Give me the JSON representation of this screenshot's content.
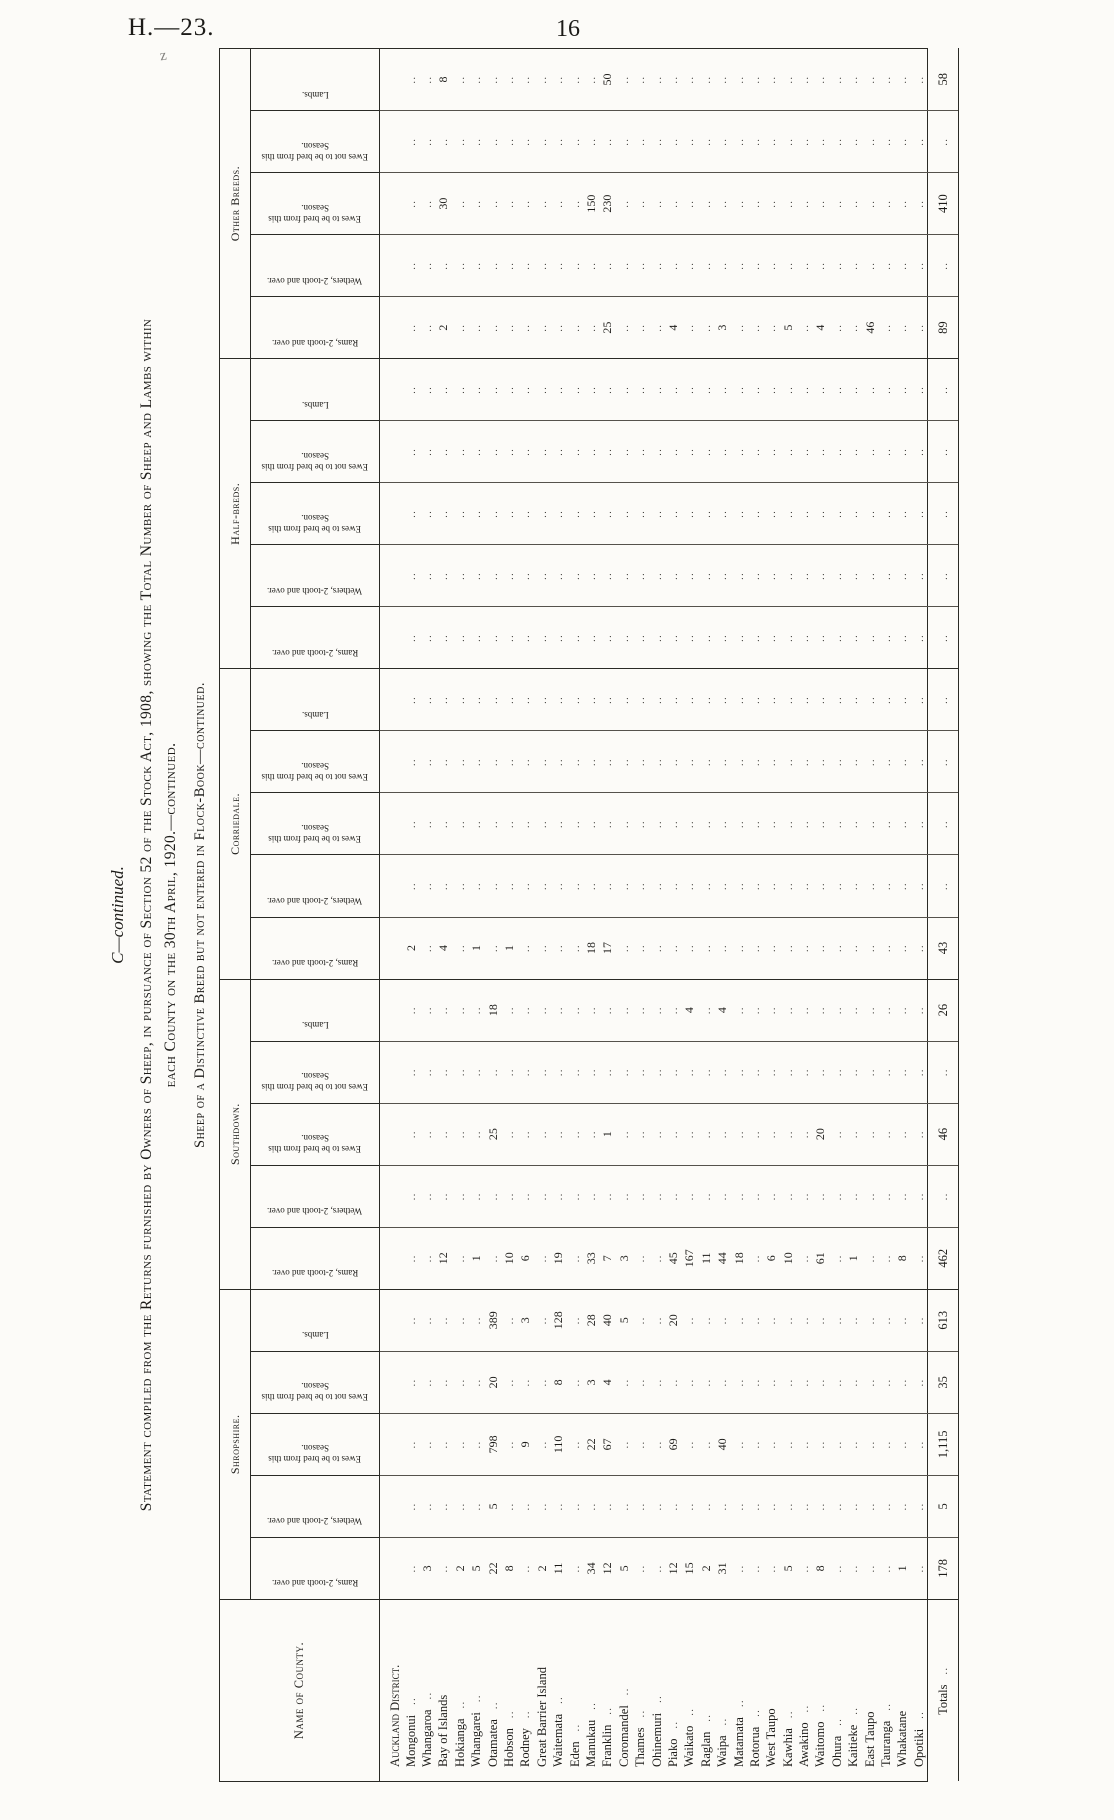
{
  "page": {
    "doc_ref": "H.—23.",
    "page_number": "16",
    "pen_mark": "z"
  },
  "heading": {
    "series": "C—continued.",
    "title_line1": "Statement compiled from the Returns furnished by Owners of Sheep, in pursuance of Section 52 of the Stock Act, 1908, showing the Total Number of Sheep and Lambs within",
    "title_line2": "each County on the 30th April, 1920.—continued.",
    "subtitle": "Sheep of a Distinctive Breed but not entered in Flock-Book—continued."
  },
  "table": {
    "name_col_header": "Name of County.",
    "empty_marker": "..",
    "group_labels": [
      "Shropshire.",
      "Southdown.",
      "Corriedale.",
      "Half-breds.",
      "Other Breeds."
    ],
    "sub_headers": [
      "Rams, 2-tooth and over.",
      "Wethers, 2-tooth and over.",
      "Ewes to be bred from this Season.",
      "Ewes not to be bred from this Season.",
      "Lambs."
    ],
    "district_header": "Auckland District.",
    "rows": [
      {
        "n": "Mongonui",
        "lr": true,
        "c": [
          "",
          "",
          "",
          "",
          "",
          "",
          "",
          "",
          "",
          "",
          "2",
          "",
          "",
          "",
          "",
          "",
          "",
          "",
          "",
          "",
          "",
          "",
          "",
          "",
          ""
        ]
      },
      {
        "n": "Whangaroa",
        "lr": true,
        "c": [
          "3",
          "",
          "",
          "",
          "",
          "",
          "",
          "",
          "",
          "",
          "",
          "",
          "",
          "",
          "",
          "",
          "",
          "",
          "",
          "",
          "",
          "",
          "",
          "",
          ""
        ]
      },
      {
        "n": "Bay of Islands",
        "lr": false,
        "c": [
          "",
          "",
          "",
          "",
          "",
          "12",
          "",
          "",
          "",
          "",
          "4",
          "",
          "",
          "",
          "",
          "",
          "",
          "",
          "",
          "",
          "2",
          "",
          "30",
          "",
          "8"
        ]
      },
      {
        "n": "Hokianga",
        "lr": true,
        "c": [
          "2",
          "",
          "",
          "",
          "",
          "",
          "",
          "",
          "",
          "",
          "",
          "",
          "",
          "",
          "",
          "",
          "",
          "",
          "",
          "",
          "",
          "",
          "",
          "",
          ""
        ]
      },
      {
        "n": "Whangarei",
        "lr": true,
        "c": [
          "5",
          "",
          "",
          "",
          "",
          "1",
          "",
          "",
          "",
          "",
          "1",
          "",
          "",
          "",
          "",
          "",
          "",
          "",
          "",
          "",
          "",
          "",
          "",
          "",
          ""
        ]
      },
      {
        "n": "Otamatea",
        "lr": true,
        "c": [
          "22",
          "5",
          "798",
          "20",
          "389",
          "",
          "",
          "25",
          "",
          "18",
          "",
          "",
          "",
          "",
          "",
          "",
          "",
          "",
          "",
          "",
          "",
          "",
          "",
          "",
          ""
        ]
      },
      {
        "n": "Hobson",
        "lr": true,
        "c": [
          "8",
          "",
          "",
          "",
          "",
          "10",
          "",
          "",
          "",
          "",
          "1",
          "",
          "",
          "",
          "",
          "",
          "",
          "",
          "",
          "",
          "",
          "",
          "",
          "",
          ""
        ]
      },
      {
        "n": "Rodney",
        "lr": true,
        "c": [
          "",
          "",
          "9",
          "",
          "3",
          "6",
          "",
          "",
          "",
          "",
          "",
          "",
          "",
          "",
          "",
          "",
          "",
          "",
          "",
          "",
          "",
          "",
          "",
          "",
          ""
        ]
      },
      {
        "n": "Great Barrier Island",
        "lr": false,
        "c": [
          "2",
          "",
          "",
          "",
          "",
          "",
          "",
          "",
          "",
          "",
          "",
          "",
          "",
          "",
          "",
          "",
          "",
          "",
          "",
          "",
          "",
          "",
          "",
          "",
          ""
        ]
      },
      {
        "n": "Waitemata",
        "lr": true,
        "c": [
          "11",
          "",
          "110",
          "8",
          "128",
          "19",
          "",
          "",
          "",
          "",
          "",
          "",
          "",
          "",
          "",
          "",
          "",
          "",
          "",
          "",
          "",
          "",
          "",
          "",
          ""
        ]
      },
      {
        "n": "Eden",
        "lr": true,
        "c": [
          "",
          "",
          "",
          "",
          "",
          "",
          "",
          "",
          "",
          "",
          "",
          "",
          "",
          "",
          "",
          "",
          "",
          "",
          "",
          "",
          "",
          "",
          "",
          "",
          ""
        ]
      },
      {
        "n": "Manukau",
        "lr": true,
        "c": [
          "34",
          "",
          "22",
          "3",
          "28",
          "33",
          "",
          "",
          "",
          "",
          "18",
          "",
          "",
          "",
          "",
          "",
          "",
          "",
          "",
          "",
          "",
          "",
          "150",
          "",
          ""
        ]
      },
      {
        "n": "Franklin",
        "lr": true,
        "c": [
          "12",
          "",
          "67",
          "4",
          "40",
          "7",
          "",
          "1",
          "",
          "",
          "17",
          "",
          "",
          "",
          "",
          "",
          "",
          "",
          "",
          "",
          "25",
          "",
          "230",
          "",
          "50"
        ]
      },
      {
        "n": "Coromandel",
        "lr": true,
        "c": [
          "5",
          "",
          "",
          "",
          "5",
          "3",
          "",
          "",
          "",
          "",
          "",
          "",
          "",
          "",
          "",
          "",
          "",
          "",
          "",
          "",
          "",
          "",
          "",
          "",
          ""
        ]
      },
      {
        "n": "Thames",
        "lr": true,
        "c": [
          "",
          "",
          "",
          "",
          "",
          "",
          "",
          "",
          "",
          "",
          "",
          "",
          "",
          "",
          "",
          "",
          "",
          "",
          "",
          "",
          "",
          "",
          "",
          "",
          ""
        ]
      },
      {
        "n": "Ohinemuri",
        "lr": true,
        "c": [
          "",
          "",
          "",
          "",
          "",
          "",
          "",
          "",
          "",
          "",
          "",
          "",
          "",
          "",
          "",
          "",
          "",
          "",
          "",
          "",
          "",
          "",
          "",
          "",
          ""
        ]
      },
      {
        "n": "Piako",
        "lr": true,
        "c": [
          "12",
          "",
          "69",
          "",
          "20",
          "45",
          "",
          "",
          "",
          "",
          "",
          "",
          "",
          "",
          "",
          "",
          "",
          "",
          "",
          "",
          "4",
          "",
          "",
          "",
          ""
        ]
      },
      {
        "n": "Waikato",
        "lr": true,
        "c": [
          "15",
          "",
          "",
          "",
          "",
          "167",
          "",
          "",
          "",
          "4",
          "",
          "",
          "",
          "",
          "",
          "",
          "",
          "",
          "",
          "",
          "",
          "",
          "",
          "",
          ""
        ]
      },
      {
        "n": "Raglan",
        "lr": true,
        "c": [
          "2",
          "",
          "",
          "",
          "",
          "11",
          "",
          "",
          "",
          "",
          "",
          "",
          "",
          "",
          "",
          "",
          "",
          "",
          "",
          "",
          "",
          "",
          "",
          "",
          ""
        ]
      },
      {
        "n": "Waipa",
        "lr": true,
        "c": [
          "31",
          "",
          "40",
          "",
          "",
          "44",
          "",
          "",
          "",
          "4",
          "",
          "",
          "",
          "",
          "",
          "",
          "",
          "",
          "",
          "",
          "3",
          "",
          "",
          "",
          ""
        ]
      },
      {
        "n": "Matamata",
        "lr": true,
        "c": [
          "",
          "",
          "",
          "",
          "",
          "18",
          "",
          "",
          "",
          "",
          "",
          "",
          "",
          "",
          "",
          "",
          "",
          "",
          "",
          "",
          "",
          "",
          "",
          "",
          ""
        ]
      },
      {
        "n": "Rotorua",
        "lr": true,
        "c": [
          "",
          "",
          "",
          "",
          "",
          "",
          "",
          "",
          "",
          "",
          "",
          "",
          "",
          "",
          "",
          "",
          "",
          "",
          "",
          "",
          "",
          "",
          "",
          "",
          ""
        ]
      },
      {
        "n": "West Taupo",
        "lr": false,
        "c": [
          "",
          "",
          "",
          "",
          "",
          "6",
          "",
          "",
          "",
          "",
          "",
          "",
          "",
          "",
          "",
          "",
          "",
          "",
          "",
          "",
          "",
          "",
          "",
          "",
          ""
        ]
      },
      {
        "n": "Kawhia",
        "lr": true,
        "c": [
          "5",
          "",
          "",
          "",
          "",
          "10",
          "",
          "",
          "",
          "",
          "",
          "",
          "",
          "",
          "",
          "",
          "",
          "",
          "",
          "",
          "5",
          "",
          "",
          "",
          ""
        ]
      },
      {
        "n": "Awakino",
        "lr": true,
        "c": [
          "",
          "",
          "",
          "",
          "",
          "",
          "",
          "",
          "",
          "",
          "",
          "",
          "",
          "",
          "",
          "",
          "",
          "",
          "",
          "",
          "",
          "",
          "",
          "",
          ""
        ]
      },
      {
        "n": "Waitomo",
        "lr": true,
        "c": [
          "8",
          "",
          "",
          "",
          "",
          "61",
          "",
          "20",
          "",
          "",
          "",
          "",
          "",
          "",
          "",
          "",
          "",
          "",
          "",
          "",
          "4",
          "",
          "",
          "",
          ""
        ]
      },
      {
        "n": "Ohura",
        "lr": true,
        "c": [
          "",
          "",
          "",
          "",
          "",
          "",
          "",
          "",
          "",
          "",
          "",
          "",
          "",
          "",
          "",
          "",
          "",
          "",
          "",
          "",
          "",
          "",
          "",
          "",
          ""
        ]
      },
      {
        "n": "Kaitieke",
        "lr": true,
        "c": [
          "",
          "",
          "",
          "",
          "",
          "1",
          "",
          "",
          "",
          "",
          "",
          "",
          "",
          "",
          "",
          "",
          "",
          "",
          "",
          "",
          "",
          "",
          "",
          "",
          ""
        ]
      },
      {
        "n": "East Taupo",
        "lr": false,
        "c": [
          "",
          "",
          "",
          "",
          "",
          "",
          "",
          "",
          "",
          "",
          "",
          "",
          "",
          "",
          "",
          "",
          "",
          "",
          "",
          "",
          "46",
          "",
          "",
          "",
          ""
        ]
      },
      {
        "n": "Tauranga",
        "lr": true,
        "c": [
          "",
          "",
          "",
          "",
          "",
          "",
          "",
          "",
          "",
          "",
          "",
          "",
          "",
          "",
          "",
          "",
          "",
          "",
          "",
          "",
          "",
          "",
          "",
          "",
          ""
        ]
      },
      {
        "n": "Whakatane",
        "lr": false,
        "c": [
          "1",
          "",
          "",
          "",
          "",
          "8",
          "",
          "",
          "",
          "",
          "",
          "",
          "",
          "",
          "",
          "",
          "",
          "",
          "",
          "",
          "",
          "",
          "",
          "",
          ""
        ]
      },
      {
        "n": "Opotiki",
        "lr": true,
        "c": [
          "",
          "",
          "",
          "",
          "",
          "",
          "",
          "",
          "",
          "",
          "",
          "",
          "",
          "",
          "",
          "",
          "",
          "",
          "",
          "",
          "",
          "",
          "",
          "",
          ""
        ]
      }
    ],
    "totals": {
      "label": "Totals",
      "cells": [
        "178",
        "5",
        "1,115",
        "35",
        "613",
        "462",
        "",
        "46",
        "",
        "26",
        "43",
        "",
        "",
        "",
        "",
        "",
        "",
        "",
        "",
        "",
        "89",
        "",
        "410",
        "",
        "58"
      ]
    }
  }
}
